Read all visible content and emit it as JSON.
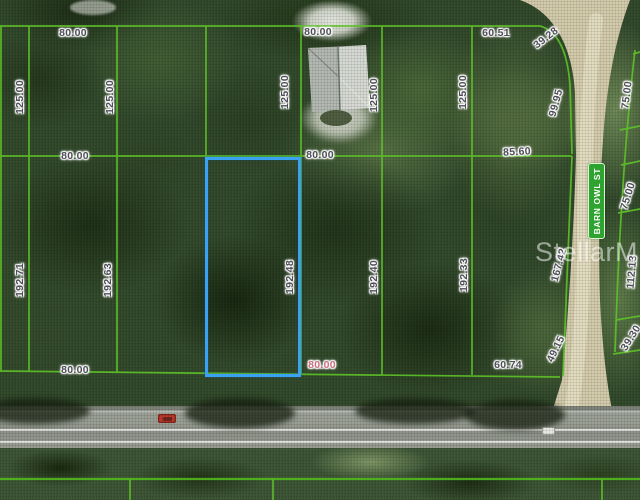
{
  "map_overlay": {
    "watermark": "StellarMLS",
    "street_sign": "BARN OWL ST",
    "selected_parcel": {
      "frontage_ft": "80.00",
      "depth_ft": "192.48",
      "outline_color": "#3BA1F3"
    },
    "colors": {
      "grid_line": "#5EC228",
      "label_text": "#4E4E58",
      "highlight_label": "#CC7080",
      "sign_green": "#2FA32F"
    },
    "labels": [
      {
        "text": "80.00"
      },
      {
        "text": "80.00"
      },
      {
        "text": "60.51"
      },
      {
        "text": "39.28"
      },
      {
        "text": "125.00"
      },
      {
        "text": "125.00"
      },
      {
        "text": "125.00"
      },
      {
        "text": "125.00"
      },
      {
        "text": "125.00"
      },
      {
        "text": "99.95"
      },
      {
        "text": "75.00"
      },
      {
        "text": "80.00"
      },
      {
        "text": "80.00"
      },
      {
        "text": "85.60"
      },
      {
        "text": "192.71"
      },
      {
        "text": "192.63"
      },
      {
        "text": "192.48"
      },
      {
        "text": "192.40"
      },
      {
        "text": "192.33"
      },
      {
        "text": "167.42"
      },
      {
        "text": "75.00"
      },
      {
        "text": "112.13"
      },
      {
        "text": "80.00"
      },
      {
        "text": "80.00"
      },
      {
        "text": "60.74"
      },
      {
        "text": "49.15"
      },
      {
        "text": "39.30"
      }
    ]
  }
}
